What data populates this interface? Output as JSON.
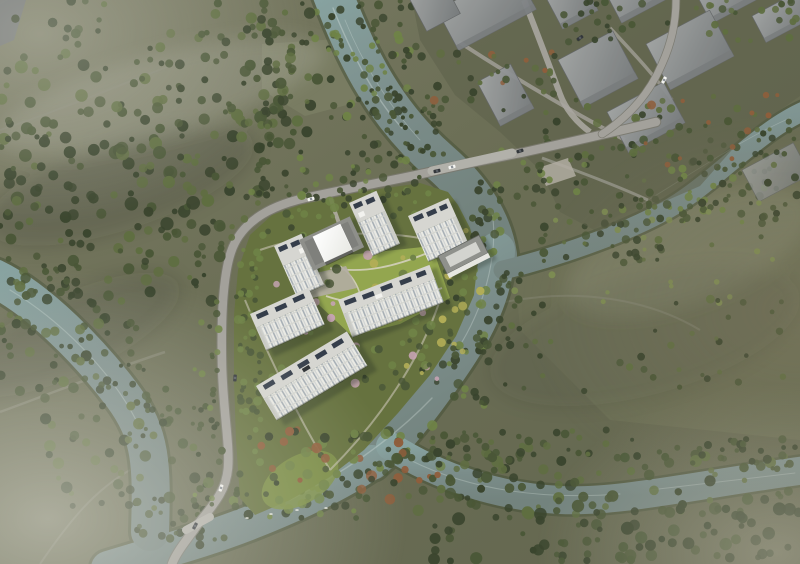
{
  "scene": {
    "kind": "aerial-architectural-rendering",
    "palette": {
      "terrain_top": "#7a7b64",
      "terrain_base": "#6b6e55",
      "terrain_deep": "#63664f",
      "terrain_right": "#71745a",
      "field_light": "#82856a",
      "site_green": "#66723f",
      "lawn": "#93a64f",
      "lawn_tip": "#7e9147",
      "forest_dark": "#3a452e",
      "forest_mid": "#4a5737",
      "forest_light": "#5f6e41",
      "tree_bright": "#6f8347",
      "tree_pale": "#7d8c52",
      "yellow_tree": "#b2ad57",
      "blossom": "#c5a3b2",
      "accent_red": "#8f5e3c",
      "water_hi": "#87a2a0",
      "water": "#7b8d8a",
      "water_lo": "#73837e",
      "bank": "#4c573d",
      "road": "#a3a19b",
      "road_edge": "#7a796f",
      "bridge_deck": "#b2b1aa",
      "path": "#b7b2a6",
      "plaza": "#b2ada2",
      "building_face": "#eaeae4",
      "building_side": "#c9cac4",
      "window_line": "#97a1aa",
      "window_pane": "#c2c7ca",
      "floor_line": "#d4d5cf",
      "roof": "#d6d6d1",
      "roof_dark": "#bfc0ba",
      "panel": "#353e4b",
      "rooftop_unit": "#f2f2ee",
      "canopy": "#fdfdfb",
      "podium": "#8e8f8a",
      "podium_dark": "#7f807c",
      "amenity_roof": "#8f918c",
      "amenity_inner": "#d3d4cf",
      "context_hi": "#a4a7a8",
      "context_lo": "#797d80",
      "context_edge": "#65686b",
      "corner_block": "#6f7274",
      "car_white": "#f4f4f1",
      "car_dark": "#33373b",
      "boat": "#f0f0ea",
      "fog": "#e4e3da"
    },
    "tree_clusters": [
      {
        "layer": "left",
        "x": 0,
        "y": 0,
        "w": 300,
        "h": 58,
        "n": 34,
        "seed": 1,
        "rmin": 2.5,
        "rmax": 5,
        "colors": [
          "forest_mid",
          "forest_dark",
          "forest_light"
        ]
      },
      {
        "layer": "left",
        "x": 0,
        "y": 55,
        "w": 280,
        "h": 82,
        "n": 72,
        "seed": 2,
        "rmin": 2.5,
        "rmax": 6.5,
        "colors": [
          "forest_dark",
          "forest_mid",
          "forest_mid",
          "forest_light"
        ]
      },
      {
        "layer": "left",
        "x": 0,
        "y": 135,
        "w": 268,
        "h": 92,
        "n": 95,
        "seed": 3,
        "rmin": 2.5,
        "rmax": 7,
        "colors": [
          "forest_dark",
          "forest_dark",
          "forest_mid",
          "forest_light"
        ]
      },
      {
        "layer": "left",
        "x": 10,
        "y": 225,
        "w": 225,
        "h": 78,
        "n": 58,
        "seed": 4,
        "rmin": 2.5,
        "rmax": 6,
        "colors": [
          "forest_mid",
          "forest_dark",
          "forest_light"
        ]
      },
      {
        "layer": "left",
        "x": 240,
        "y": 0,
        "w": 85,
        "h": 145,
        "n": 52,
        "seed": 5,
        "rmin": 2.5,
        "rmax": 6,
        "colors": [
          "forest_dark",
          "forest_mid",
          "forest_light"
        ]
      },
      {
        "layer": "left",
        "x": 0,
        "y": 303,
        "w": 118,
        "h": 92,
        "n": 32,
        "seed": 6,
        "rmin": 2.5,
        "rmax": 5.5,
        "colors": [
          "forest_mid",
          "forest_dark",
          "forest_light"
        ]
      },
      {
        "layer": "left",
        "x": 40,
        "y": 398,
        "w": 170,
        "h": 112,
        "n": 44,
        "seed": 7,
        "rmin": 2.5,
        "rmax": 6,
        "colors": [
          "forest_dark",
          "forest_mid",
          "forest_light"
        ]
      },
      {
        "layer": "left",
        "x": 480,
        "y": 200,
        "w": 310,
        "h": 118,
        "n": 40,
        "seed": 8,
        "rmin": 2,
        "rmax": 4.5,
        "colors": [
          "forest_mid",
          "forest_light",
          "tree_pale"
        ]
      },
      {
        "layer": "left",
        "x": 505,
        "y": 300,
        "w": 280,
        "h": 92,
        "n": 36,
        "seed": 9,
        "rmin": 2,
        "rmax": 4,
        "colors": [
          "forest_mid",
          "forest_light",
          "forest_dark"
        ]
      },
      {
        "layer": "left",
        "x": 758,
        "y": 118,
        "w": 42,
        "h": 120,
        "n": 16,
        "seed": 10,
        "rmin": 2,
        "rmax": 4.5,
        "colors": [
          "forest_mid",
          "forest_dark"
        ]
      },
      {
        "layer": "banks",
        "x": 395,
        "y": 452,
        "w": 405,
        "h": 62,
        "n": 92,
        "seed": 11,
        "rmin": 2.5,
        "rmax": 6,
        "colors": [
          "forest_dark",
          "forest_mid",
          "forest_light"
        ]
      },
      {
        "layer": "banks",
        "x": 430,
        "y": 505,
        "w": 370,
        "h": 58,
        "n": 78,
        "seed": 12,
        "rmin": 2.5,
        "rmax": 6.5,
        "colors": [
          "forest_dark",
          "forest_mid"
        ]
      },
      {
        "layer": "banks",
        "x": 430,
        "y": 426,
        "w": 200,
        "h": 36,
        "n": 40,
        "seed": 13,
        "rmin": 2,
        "rmax": 5,
        "colors": [
          "forest_mid",
          "forest_dark",
          "forest_light"
        ]
      },
      {
        "layer": "banks",
        "x": 630,
        "y": 438,
        "w": 170,
        "h": 32,
        "n": 30,
        "seed": 14,
        "rmin": 2,
        "rmax": 4.5,
        "colors": [
          "forest_mid",
          "forest_dark"
        ]
      },
      {
        "layer": "banks",
        "x": 296,
        "y": 0,
        "w": 46,
        "h": 58,
        "n": 18,
        "seed": 15,
        "rmin": 2,
        "rmax": 4.5,
        "colors": [
          "forest_mid",
          "forest_dark",
          "tree_bright"
        ]
      },
      {
        "layer": "banks",
        "x": 326,
        "y": 48,
        "w": 54,
        "h": 80,
        "n": 24,
        "seed": 16,
        "rmin": 2,
        "rmax": 4.5,
        "colors": [
          "forest_dark",
          "forest_mid",
          "tree_bright"
        ]
      },
      {
        "layer": "banks",
        "x": 356,
        "y": 108,
        "w": 52,
        "h": 62,
        "n": 20,
        "seed": 17,
        "rmin": 2,
        "rmax": 4.5,
        "colors": [
          "forest_mid",
          "forest_dark"
        ]
      },
      {
        "layer": "banks",
        "x": 358,
        "y": 0,
        "w": 54,
        "h": 52,
        "n": 20,
        "seed": 18,
        "rmin": 2,
        "rmax": 4.5,
        "colors": [
          "forest_mid",
          "tree_bright",
          "forest_dark"
        ]
      },
      {
        "layer": "banks",
        "x": 382,
        "y": 42,
        "w": 48,
        "h": 72,
        "n": 22,
        "seed": 19,
        "rmin": 2,
        "rmax": 4.5,
        "colors": [
          "forest_mid",
          "forest_dark",
          "tree_bright"
        ]
      },
      {
        "layer": "banks",
        "x": 402,
        "y": 100,
        "w": 46,
        "h": 58,
        "n": 18,
        "seed": 20,
        "rmin": 2,
        "rmax": 4,
        "colors": [
          "forest_mid",
          "forest_dark"
        ]
      },
      {
        "layer": "banks",
        "x": 470,
        "y": 180,
        "w": 34,
        "h": 90,
        "n": 22,
        "seed": 21,
        "rmin": 2,
        "rmax": 4.5,
        "colors": [
          "forest_mid",
          "forest_dark",
          "tree_bright"
        ]
      },
      {
        "layer": "banks",
        "x": 485,
        "y": 270,
        "w": 36,
        "h": 80,
        "n": 20,
        "seed": 22,
        "rmin": 2,
        "rmax": 4.5,
        "colors": [
          "forest_mid",
          "forest_dark"
        ]
      },
      {
        "layer": "banks",
        "x": 448,
        "y": 330,
        "w": 42,
        "h": 80,
        "n": 24,
        "seed": 23,
        "rmin": 2.5,
        "rmax": 5,
        "colors": [
          "tree_bright",
          "forest_mid",
          "forest_dark"
        ]
      },
      {
        "layer": "banks",
        "x": 350,
        "y": 425,
        "w": 105,
        "h": 58,
        "n": 36,
        "seed": 24,
        "rmin": 2.5,
        "rmax": 5.5,
        "colors": [
          "forest_mid",
          "forest_dark",
          "tree_bright",
          "accent_red"
        ]
      },
      {
        "layer": "banks",
        "x": 230,
        "y": 468,
        "w": 130,
        "h": 52,
        "n": 40,
        "seed": 25,
        "rmin": 2.5,
        "rmax": 5,
        "colors": [
          "forest_dark",
          "forest_mid",
          "tree_bright"
        ]
      },
      {
        "layer": "banks",
        "x": 125,
        "y": 498,
        "w": 112,
        "h": 48,
        "n": 28,
        "seed": 26,
        "rmin": 2,
        "rmax": 4.5,
        "colors": [
          "forest_mid",
          "forest_dark"
        ]
      },
      {
        "layer": "banks",
        "x": 0,
        "y": 258,
        "w": 72,
        "h": 42,
        "n": 16,
        "seed": 27,
        "rmin": 2,
        "rmax": 4.5,
        "colors": [
          "forest_mid",
          "forest_dark"
        ]
      },
      {
        "layer": "banks",
        "x": 52,
        "y": 308,
        "w": 92,
        "h": 62,
        "n": 20,
        "seed": 28,
        "rmin": 2,
        "rmax": 4.5,
        "colors": [
          "forest_dark",
          "forest_mid"
        ]
      },
      {
        "layer": "banks",
        "x": 98,
        "y": 378,
        "w": 84,
        "h": 62,
        "n": 20,
        "seed": 29,
        "rmin": 2,
        "rmax": 4.5,
        "colors": [
          "forest_mid",
          "forest_dark"
        ]
      },
      {
        "layer": "banks",
        "x": 640,
        "y": 172,
        "w": 140,
        "h": 52,
        "n": 30,
        "seed": 30,
        "rmin": 2,
        "rmax": 4.5,
        "colors": [
          "forest_mid",
          "forest_dark",
          "tree_bright"
        ]
      },
      {
        "layer": "banks",
        "x": 540,
        "y": 222,
        "w": 122,
        "h": 46,
        "n": 26,
        "seed": 31,
        "rmin": 2,
        "rmax": 4.5,
        "colors": [
          "forest_mid",
          "forest_dark"
        ]
      },
      {
        "layer": "banks",
        "x": 692,
        "y": 138,
        "w": 92,
        "h": 40,
        "n": 20,
        "seed": 32,
        "rmin": 2,
        "rmax": 4,
        "colors": [
          "forest_mid",
          "forest_dark"
        ]
      },
      {
        "layer": "context",
        "x": 430,
        "y": 52,
        "w": 130,
        "h": 62,
        "n": 30,
        "seed": 33,
        "rmin": 2,
        "rmax": 4.5,
        "colors": [
          "forest_mid",
          "forest_light",
          "accent_red",
          "forest_dark"
        ]
      },
      {
        "layer": "context",
        "x": 545,
        "y": 95,
        "w": 130,
        "h": 70,
        "n": 30,
        "seed": 34,
        "rmin": 2,
        "rmax": 4.5,
        "colors": [
          "forest_mid",
          "forest_dark",
          "forest_light"
        ]
      },
      {
        "layer": "context",
        "x": 630,
        "y": 95,
        "w": 150,
        "h": 70,
        "n": 32,
        "seed": 35,
        "rmin": 2,
        "rmax": 4.5,
        "colors": [
          "forest_mid",
          "forest_light",
          "accent_red"
        ]
      },
      {
        "layer": "context",
        "x": 560,
        "y": 0,
        "w": 120,
        "h": 45,
        "n": 22,
        "seed": 36,
        "rmin": 2,
        "rmax": 4,
        "colors": [
          "forest_mid",
          "forest_dark"
        ]
      },
      {
        "layer": "context",
        "x": 690,
        "y": 0,
        "w": 110,
        "h": 50,
        "n": 22,
        "seed": 37,
        "rmin": 2,
        "rmax": 4,
        "colors": [
          "forest_mid",
          "forest_light"
        ]
      },
      {
        "layer": "context",
        "x": 500,
        "y": 140,
        "w": 90,
        "h": 58,
        "n": 24,
        "seed": 38,
        "rmin": 2,
        "rmax": 4.5,
        "colors": [
          "forest_mid",
          "forest_dark",
          "tree_bright"
        ]
      },
      {
        "layer": "context",
        "x": 615,
        "y": 162,
        "w": 120,
        "h": 48,
        "n": 26,
        "seed": 39,
        "rmin": 2,
        "rmax": 4.5,
        "colors": [
          "forest_mid",
          "tree_bright",
          "forest_dark"
        ]
      },
      {
        "layer": "road",
        "x": 192,
        "y": 210,
        "w": 30,
        "h": 295,
        "n": 40,
        "seed": 40,
        "rmin": 2,
        "rmax": 4,
        "colors": [
          "tree_bright",
          "forest_mid",
          "forest_dark"
        ]
      },
      {
        "layer": "road",
        "x": 236,
        "y": 228,
        "w": 22,
        "h": 275,
        "n": 28,
        "seed": 41,
        "rmin": 2,
        "rmax": 4,
        "colors": [
          "forest_mid",
          "tree_bright"
        ]
      },
      {
        "layer": "road",
        "x": 255,
        "y": 150,
        "w": 168,
        "h": 44,
        "n": 30,
        "seed": 42,
        "rmin": 2,
        "rmax": 4.2,
        "colors": [
          "forest_mid",
          "tree_bright",
          "forest_dark"
        ]
      },
      {
        "layer": "site",
        "x": 244,
        "y": 192,
        "w": 120,
        "h": 46,
        "n": 28,
        "seed": 43,
        "rmin": 2.2,
        "rmax": 4.8,
        "colors": [
          "tree_bright",
          "forest_mid",
          "forest_dark"
        ]
      },
      {
        "layer": "site",
        "x": 444,
        "y": 205,
        "w": 48,
        "h": 150,
        "n": 38,
        "seed": 44,
        "rmin": 2.2,
        "rmax": 5,
        "colors": [
          "tree_bright",
          "forest_mid",
          "yellow_tree",
          "forest_dark"
        ]
      },
      {
        "layer": "site",
        "x": 250,
        "y": 428,
        "w": 140,
        "h": 72,
        "n": 44,
        "seed": 45,
        "rmin": 2.5,
        "rmax": 5.5,
        "colors": [
          "forest_mid",
          "tree_bright",
          "forest_dark",
          "accent_red"
        ]
      },
      {
        "layer": "site",
        "x": 236,
        "y": 250,
        "w": 28,
        "h": 180,
        "n": 28,
        "seed": 46,
        "rmin": 2,
        "rmax": 4.5,
        "colors": [
          "tree_bright",
          "forest_mid"
        ]
      },
      {
        "layer": "site",
        "x": 256,
        "y": 280,
        "w": 78,
        "h": 100,
        "n": 24,
        "seed": 47,
        "rmin": 2,
        "rmax": 4.5,
        "colors": [
          "tree_bright",
          "forest_mid",
          "blossom",
          "forest_dark"
        ]
      },
      {
        "layer": "site",
        "x": 330,
        "y": 255,
        "w": 105,
        "h": 68,
        "n": 16,
        "seed": 48,
        "rmin": 2.2,
        "rmax": 5,
        "colors": [
          "tree_bright",
          "yellow_tree",
          "forest_mid",
          "blossom"
        ]
      },
      {
        "layer": "site",
        "x": 330,
        "y": 340,
        "w": 120,
        "h": 48,
        "n": 24,
        "seed": 49,
        "rmin": 2,
        "rmax": 4.5,
        "colors": [
          "forest_mid",
          "tree_bright",
          "blossom",
          "forest_dark"
        ]
      },
      {
        "layer": "site",
        "x": 392,
        "y": 300,
        "w": 68,
        "h": 88,
        "n": 22,
        "seed": 50,
        "rmin": 2,
        "rmax": 5,
        "colors": [
          "tree_bright",
          "forest_mid",
          "yellow_tree"
        ]
      },
      {
        "layer": "site",
        "x": 300,
        "y": 178,
        "w": 130,
        "h": 38,
        "n": 22,
        "seed": 51,
        "rmin": 2,
        "rmax": 4.2,
        "colors": [
          "tree_bright",
          "forest_mid",
          "forest_dark"
        ]
      }
    ],
    "cars": [
      {
        "x": 452,
        "y": 167,
        "rot": -14,
        "color": "car_white"
      },
      {
        "x": 437,
        "y": 171,
        "rot": -13,
        "color": "car_dark"
      },
      {
        "x": 520,
        "y": 151,
        "rot": -16,
        "color": "car_dark"
      },
      {
        "x": 311,
        "y": 199,
        "rot": -15,
        "color": "car_white"
      },
      {
        "x": 235,
        "y": 378,
        "rot": -86,
        "color": "car_dark"
      },
      {
        "x": 221,
        "y": 488,
        "rot": -72,
        "color": "car_white"
      },
      {
        "x": 195,
        "y": 526,
        "rot": -62,
        "color": "car_dark"
      },
      {
        "x": 580,
        "y": 38,
        "rot": -35,
        "color": "car_dark"
      },
      {
        "x": 664,
        "y": 80,
        "rot": -62,
        "color": "car_white"
      }
    ],
    "boats": [
      {
        "x": 247,
        "y": 518
      },
      {
        "x": 271,
        "y": 514
      },
      {
        "x": 297,
        "y": 510
      },
      {
        "x": 326,
        "y": 508
      }
    ]
  }
}
